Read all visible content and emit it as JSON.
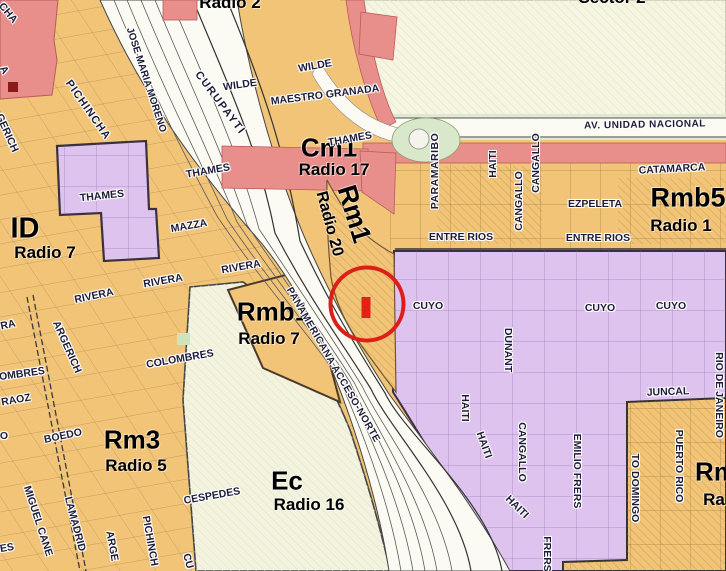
{
  "map_title": "Zoning map with radio sectors",
  "colors": {
    "residential_orange": "#F1C478",
    "residential_purple": "#DFC3EF",
    "commercial_pink": "#E88E8B",
    "open_cream": "#F5F5E1",
    "ec_cream": "#F3F3DF",
    "road_white": "#FBFBF3",
    "park_green": "#D9E7CB",
    "annotation_red": "#DE1F18"
  },
  "annotation": {
    "circle_color": "#DE1F18",
    "marker_color": "#E42017"
  },
  "zone_labels": [
    {
      "text": "Radio 2",
      "x": 230,
      "y": 3,
      "rot": 0,
      "size": 17
    },
    {
      "text": "Sector 2",
      "x": 612,
      "y": -2,
      "rot": 0,
      "size": 17
    },
    {
      "text": "Cm1",
      "x": 329,
      "y": 148,
      "rot": 0,
      "size": 26
    },
    {
      "text": "Radio 17",
      "x": 334,
      "y": 170,
      "rot": 0,
      "size": 17
    },
    {
      "text": "Rm1",
      "x": 354,
      "y": 214,
      "rot": 73,
      "size": 27
    },
    {
      "text": "Radio 20",
      "x": 329,
      "y": 224,
      "rot": 75,
      "size": 16
    },
    {
      "text": "ID",
      "x": 25,
      "y": 229,
      "rot": 0,
      "size": 29
    },
    {
      "text": "Radio 7",
      "x": 45,
      "y": 253,
      "rot": 0,
      "size": 17
    },
    {
      "text": "Rmb5",
      "x": 688,
      "y": 198,
      "rot": 0,
      "size": 27
    },
    {
      "text": "Radio 1",
      "x": 681,
      "y": 226,
      "rot": 0,
      "size": 17
    },
    {
      "text": "Rmb1",
      "x": 273,
      "y": 312,
      "rot": 0,
      "size": 26
    },
    {
      "text": "Radio 7",
      "x": 269,
      "y": 339,
      "rot": 0,
      "size": 17
    },
    {
      "text": "Rm3",
      "x": 132,
      "y": 440,
      "rot": 0,
      "size": 26
    },
    {
      "text": "Radio 5",
      "x": 136,
      "y": 466,
      "rot": 0,
      "size": 17
    },
    {
      "text": "Ec",
      "x": 287,
      "y": 481,
      "rot": 0,
      "size": 26
    },
    {
      "text": "Radio 16",
      "x": 309,
      "y": 505,
      "rot": 0,
      "size": 17
    },
    {
      "text": "Rm",
      "x": 716,
      "y": 472,
      "rot": 0,
      "size": 26
    },
    {
      "text": "Ra",
      "x": 714,
      "y": 500,
      "rot": 0,
      "size": 17
    }
  ],
  "street_labels": [
    {
      "text": "WILDE",
      "x": 240,
      "y": 85,
      "rot": -8
    },
    {
      "text": "WILDE",
      "x": 315,
      "y": 66,
      "rot": -10
    },
    {
      "text": "MAESTRO GRANADA",
      "x": 325,
      "y": 95,
      "rot": -7
    },
    {
      "text": "THAMES",
      "x": 102,
      "y": 196,
      "rot": -6
    },
    {
      "text": "THAMES",
      "x": 208,
      "y": 171,
      "rot": -10
    },
    {
      "text": "THAMES",
      "x": 350,
      "y": 139,
      "rot": -10
    },
    {
      "text": "MAZZA",
      "x": 189,
      "y": 226,
      "rot": -10
    },
    {
      "text": "RIVERA",
      "x": 94,
      "y": 296,
      "rot": -12
    },
    {
      "text": "RIVERA",
      "x": 163,
      "y": 281,
      "rot": -10
    },
    {
      "text": "RIVERA",
      "x": 241,
      "y": 267,
      "rot": -10
    },
    {
      "text": "RA",
      "x": 8,
      "y": 325,
      "rot": -12
    },
    {
      "text": "COLOMBRES",
      "x": 180,
      "y": 359,
      "rot": -10
    },
    {
      "text": "OMBRES",
      "x": 22,
      "y": 374,
      "rot": -8
    },
    {
      "text": "RAOZ",
      "x": 16,
      "y": 400,
      "rot": -10
    },
    {
      "text": "BOEDO",
      "x": 63,
      "y": 436,
      "rot": -12
    },
    {
      "text": "CESPEDES",
      "x": 212,
      "y": 496,
      "rot": -10
    },
    {
      "text": "ES",
      "x": 7,
      "y": 548,
      "rot": -10
    },
    {
      "text": "O",
      "x": 4,
      "y": 436,
      "rot": 0
    },
    {
      "text": "A",
      "x": 4,
      "y": 70,
      "rot": 60
    },
    {
      "text": "CHA",
      "x": 8,
      "y": 13,
      "rot": 50
    },
    {
      "text": "GERICH",
      "x": 7,
      "y": 133,
      "rot": 66
    },
    {
      "text": "CURUPAYTI",
      "x": 220,
      "y": 103,
      "rot": 53,
      "size": 11,
      "ls": 1.5
    },
    {
      "text": "PICHINCHA",
      "x": 88,
      "y": 110,
      "rot": 55,
      "size": 11,
      "ls": 1
    },
    {
      "text": "ARGERICH",
      "x": 67,
      "y": 347,
      "rot": 66
    },
    {
      "text": "MIGUEL CANE",
      "x": 38,
      "y": 521,
      "rot": 72
    },
    {
      "text": "LAMADRID",
      "x": 75,
      "y": 524,
      "rot": 75
    },
    {
      "text": "JOSE MARIA MORENO",
      "x": 146,
      "y": 80,
      "rot": 72,
      "size": 10
    },
    {
      "text": "PANAMERICANA ACCESO-NORTE",
      "x": 333,
      "y": 365,
      "rot": 60,
      "size": 10,
      "ls": 0.5
    },
    {
      "text": "CATAMARCA",
      "x": 672,
      "y": 169,
      "rot": -3
    },
    {
      "text": "EZPELETA",
      "x": 595,
      "y": 204,
      "rot": 0
    },
    {
      "text": "ENTRE RIOS",
      "x": 461,
      "y": 237,
      "rot": 0
    },
    {
      "text": "ENTRE RIOS",
      "x": 598,
      "y": 238,
      "rot": 0
    },
    {
      "text": "AV. UNIDAD NACIONAL",
      "x": 645,
      "y": 125,
      "rot": -1,
      "size": 10,
      "ls": 0.5
    },
    {
      "text": "CUYO",
      "x": 428,
      "y": 306,
      "rot": 0
    },
    {
      "text": "CUYO",
      "x": 600,
      "y": 308,
      "rot": 0
    },
    {
      "text": "CUYO",
      "x": 671,
      "y": 306,
      "rot": 0
    },
    {
      "text": "JUNCAL",
      "x": 668,
      "y": 392,
      "rot": -2
    },
    {
      "text": "PARAMARIBO",
      "x": 435,
      "y": 171,
      "rot": -90,
      "ls": 0.5
    },
    {
      "text": "HAITI",
      "x": 493,
      "y": 164,
      "rot": -90
    },
    {
      "text": "CANGALLO",
      "x": 519,
      "y": 201,
      "rot": -90
    },
    {
      "text": "CANGALLO",
      "x": 536,
      "y": 163,
      "rot": -90
    },
    {
      "text": "DUNANT",
      "x": 508,
      "y": 350,
      "rot": 90
    },
    {
      "text": "CANGALLO",
      "x": 522,
      "y": 452,
      "rot": 90
    },
    {
      "text": "HAITI",
      "x": 465,
      "y": 408,
      "rot": 90
    },
    {
      "text": "HAITI",
      "x": 484,
      "y": 445,
      "rot": 70
    },
    {
      "text": "HAITI",
      "x": 517,
      "y": 507,
      "rot": 45
    },
    {
      "text": "EMILIO FRERS",
      "x": 577,
      "y": 471,
      "rot": 90
    },
    {
      "text": "FRERS",
      "x": 547,
      "y": 554,
      "rot": 90
    },
    {
      "text": "PUERTO RICO",
      "x": 679,
      "y": 466,
      "rot": 90
    },
    {
      "text": "TO DOMINGO",
      "x": 635,
      "y": 488,
      "rot": 90
    },
    {
      "text": "RIO DE JANEIRO",
      "x": 719,
      "y": 395,
      "rot": 90
    },
    {
      "text": "ARGE",
      "x": 112,
      "y": 546,
      "rot": 80
    },
    {
      "text": "PICHINCH",
      "x": 150,
      "y": 541,
      "rot": 80
    },
    {
      "text": "CU",
      "x": 188,
      "y": 561,
      "rot": 75
    }
  ]
}
